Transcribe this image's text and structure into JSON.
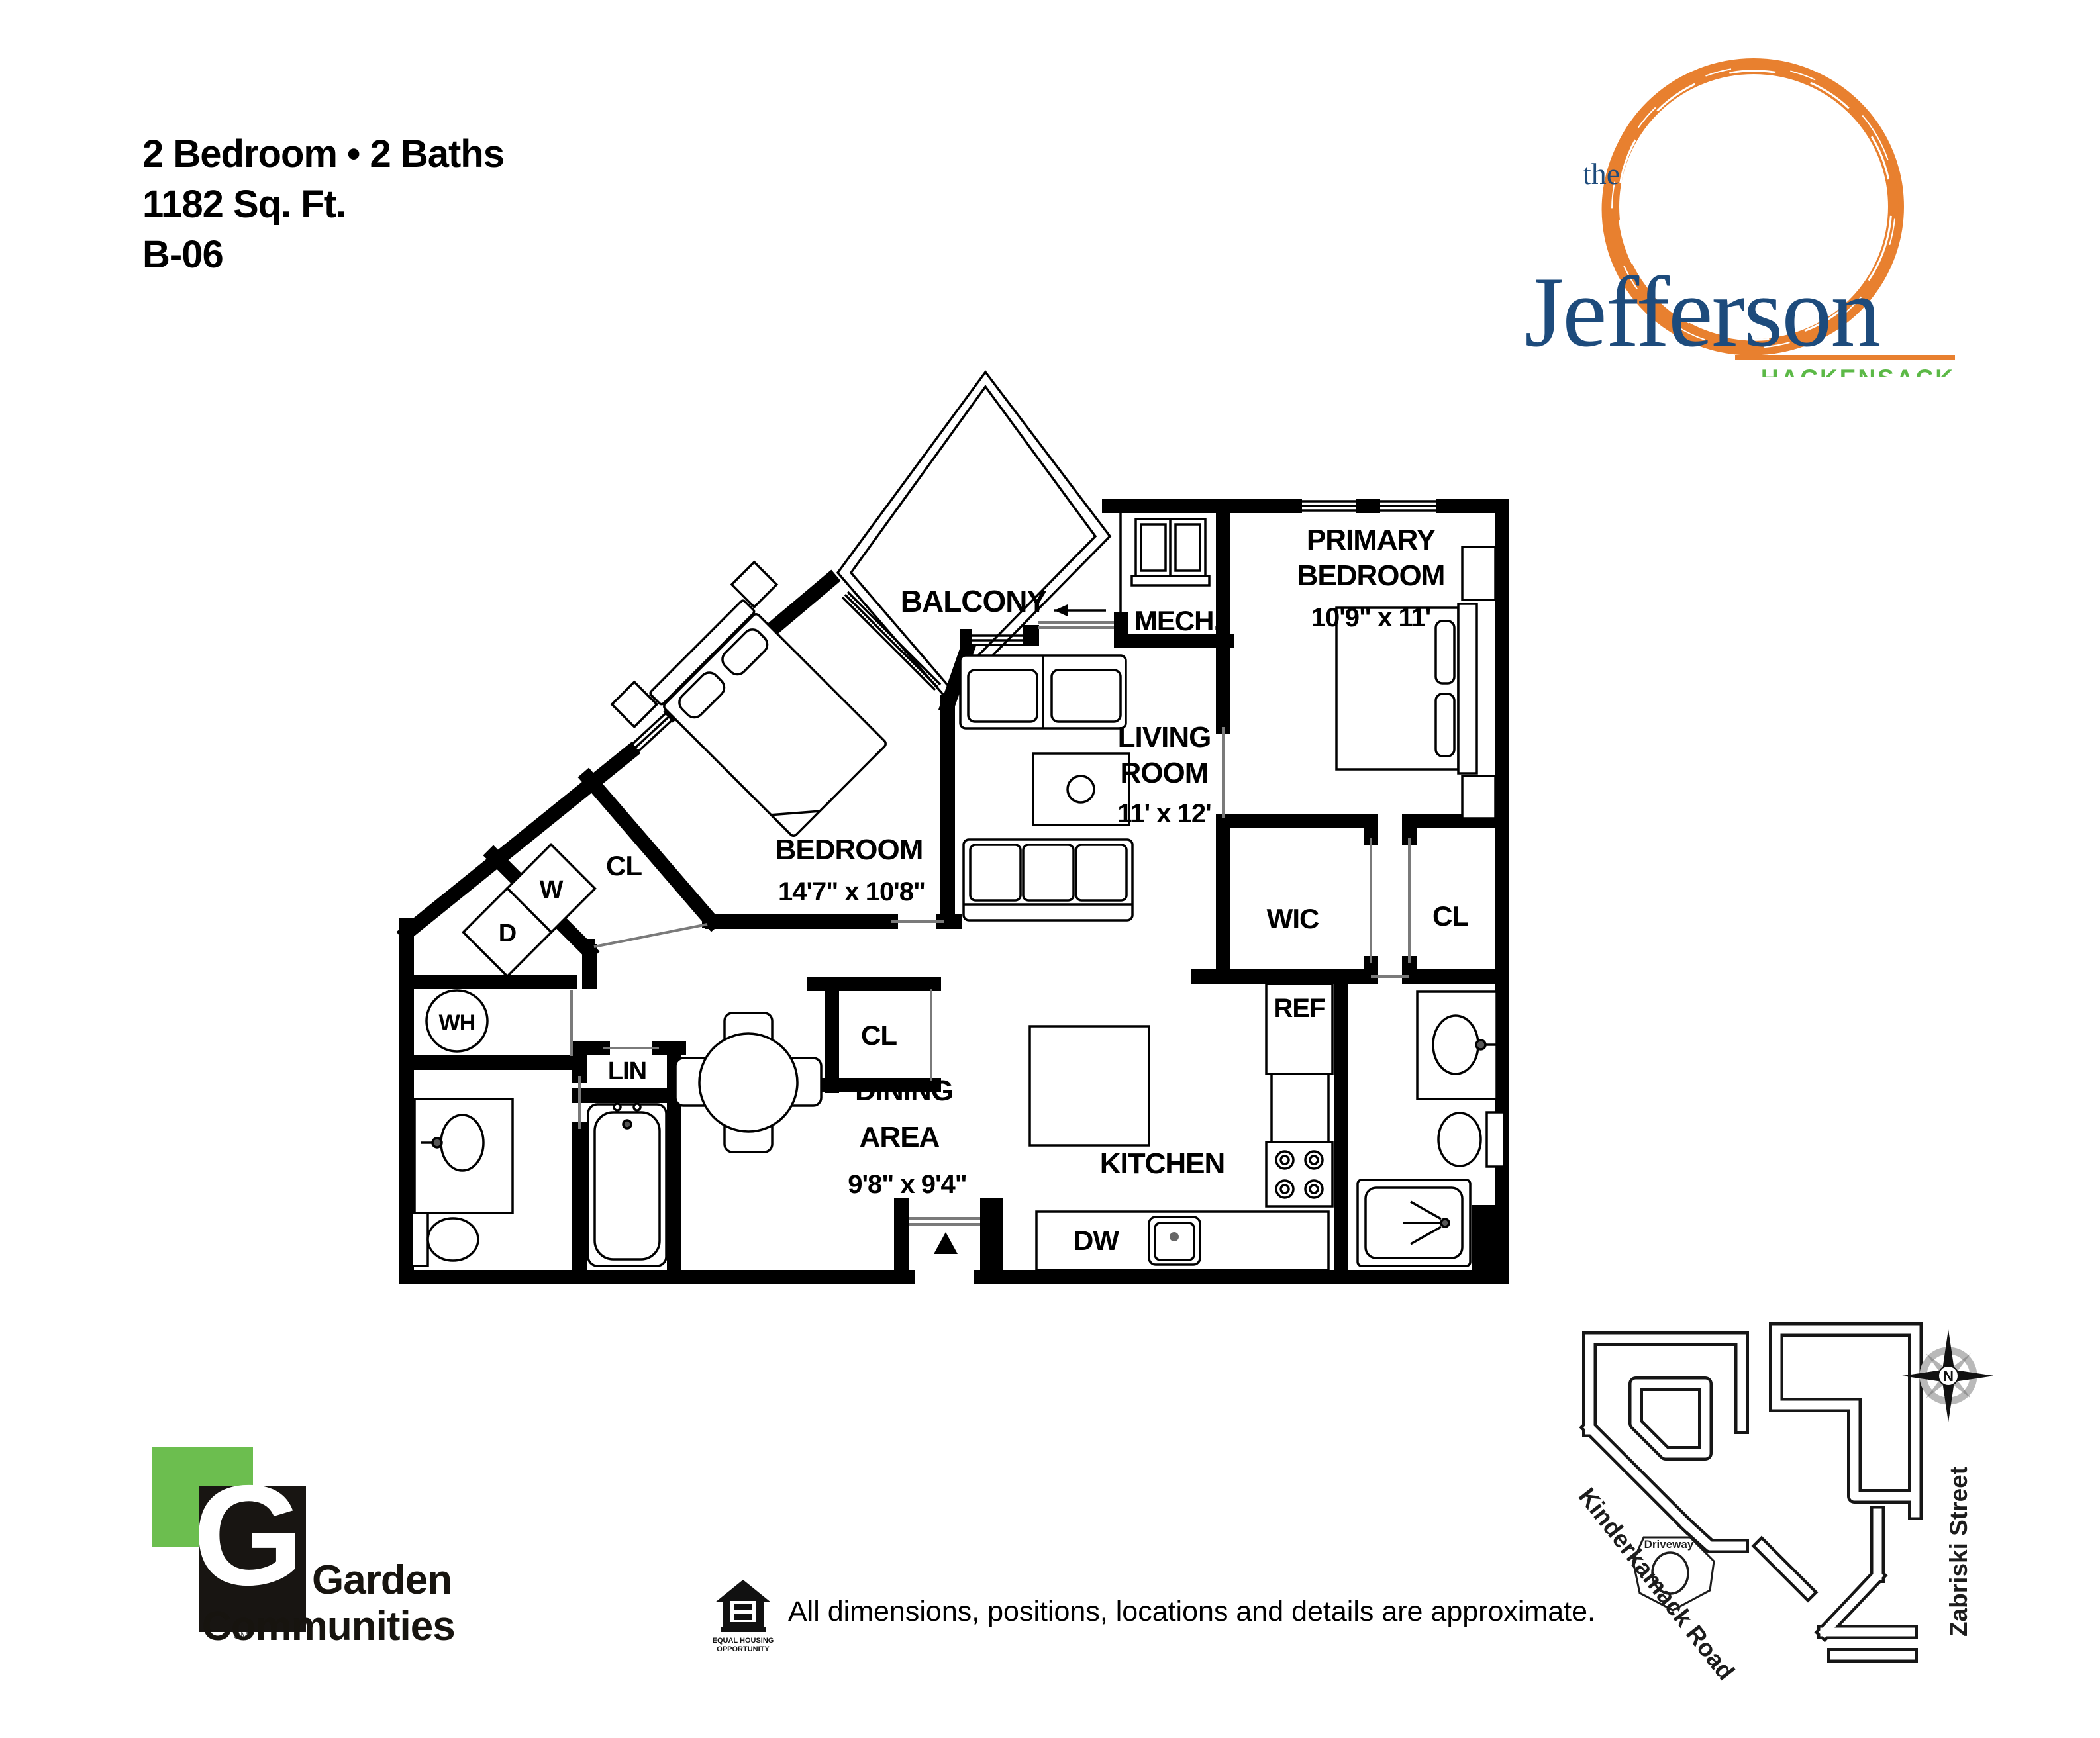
{
  "header": {
    "line1": "2 Bedroom • 2 Baths",
    "line2": "1182 Sq. Ft.",
    "line3": "B-06"
  },
  "logo": {
    "the": "the",
    "name": "Jefferson",
    "city": "HACKENSACK",
    "orange": "#E8802F",
    "navy": "#1D4B7C",
    "green": "#5CB947"
  },
  "floorplan": {
    "balcony": "BALCONY",
    "mech": "MECH.",
    "primary": {
      "l1": "PRIMARY",
      "l2": "BEDROOM",
      "dim": "10'9\" x 11'"
    },
    "living": {
      "l1": "LIVING",
      "l2": "ROOM",
      "dim": "11' x 12'"
    },
    "bedroom": {
      "l1": "BEDROOM",
      "dim": "14'7\" x 10'8\""
    },
    "dining": {
      "l1": "DINING",
      "l2": "AREA",
      "dim": "9'8\" x 9'4\""
    },
    "kitchen": "KITCHEN",
    "wic": "WIC",
    "cl_primary": "CL",
    "cl_hall": "CL",
    "cl_dining": "CL",
    "lin": "LIN",
    "wh": "WH",
    "ref": "REF",
    "dw": "DW",
    "washer": "W",
    "dryer": "D"
  },
  "sitemap": {
    "road": "Kinderkamack Road",
    "street": "Zabriski Street",
    "driveway": "Driveway",
    "compass_n": "N"
  },
  "footer": {
    "brand_g": "G",
    "brand_sm": "SM",
    "brand1": "Garden",
    "brand2": "Communities",
    "eho1": "EQUAL HOUSING",
    "eho2": "OPPORTUNITY",
    "disclaimer": "All dimensions, positions, locations and details are approximate."
  }
}
